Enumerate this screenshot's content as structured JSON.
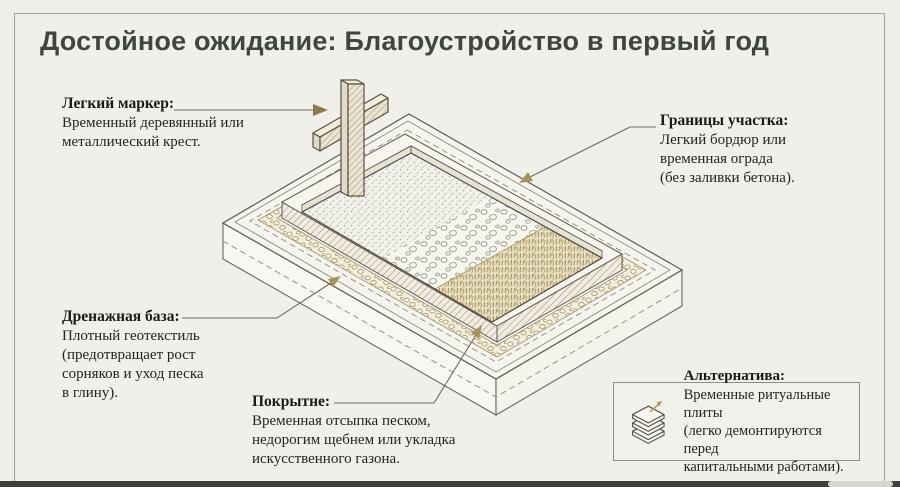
{
  "title": "Достойное ожидание: Благоустройство в первый год",
  "labels": {
    "marker": {
      "head": "Легкий маркер:",
      "lines": [
        "Временный деревянный или",
        "металлический крест."
      ]
    },
    "boundaries": {
      "head": "Границы участка:",
      "lines": [
        "Легкий бордюр или",
        "временная ограда",
        "(без заливки бетона)."
      ]
    },
    "drainage": {
      "head": "Дренажная база:",
      "lines": [
        "Плотный геотекстиль",
        "(предотвращает рост",
        "сорняков и уход песка",
        "в глину)."
      ]
    },
    "covering": {
      "head": "Покрытне:",
      "lines": [
        "Временная отсыпка песком,",
        "недорогим щебнем или укладка",
        "искусственного газона."
      ]
    },
    "alternative": {
      "head": "Альтернатива:",
      "lines": [
        "Временные ритуальные плиты",
        "(легко демонтируются перед",
        "капитальными работами)."
      ]
    }
  },
  "illustration": {
    "name": "isometric-grave-plot",
    "parts": [
      "temporary-cross",
      "boundary-curb",
      "geotextile-pebble-band",
      "sand-fill",
      "gravel-fill",
      "artificial-turf-fill",
      "base-slab"
    ],
    "icons": [
      "arrowhead-icon",
      "stacked-plates-icon"
    ]
  },
  "colors": {
    "background": "#f0efe9",
    "title_ink": "#3f4641",
    "ink": "#25241f",
    "leader_line": "#6f6b60",
    "accent_gold": "#a6945f",
    "frame_border": "#a3a398"
  }
}
